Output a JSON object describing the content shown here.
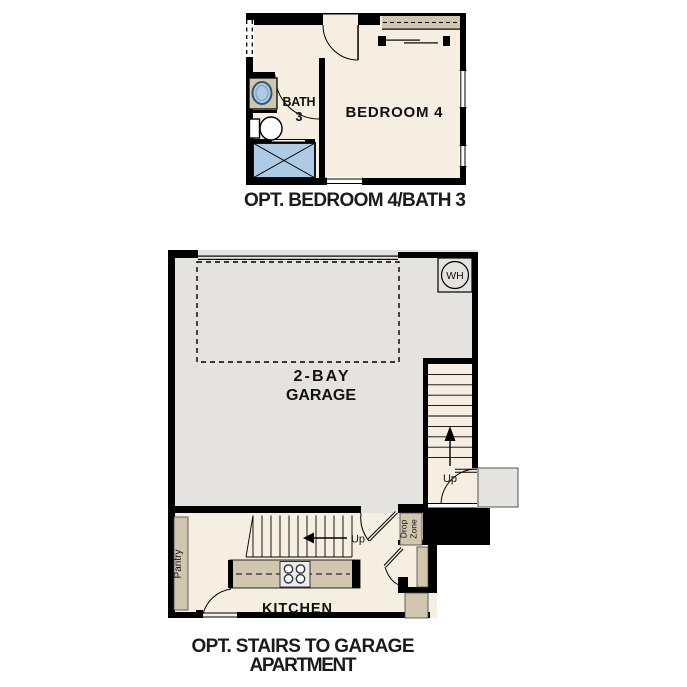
{
  "plan_bedroom": {
    "caption": "OPT. BEDROOM 4/BATH 3",
    "labels": {
      "bath_line1": "BATH",
      "bath_line2": "3",
      "bedroom": "BEDROOM 4"
    }
  },
  "plan_garage": {
    "caption_line1": "OPT. STAIRS TO GARAGE",
    "caption_line2": "APARTMENT",
    "labels": {
      "garage_line1": "2-BAY",
      "garage_line2": "GARAGE",
      "water_heater": "WH",
      "up_right_stairs": "Up",
      "up_kitchen_stairs": "Up",
      "pantry": "Pantry",
      "drop_zone_line1": "Drop",
      "drop_zone_line2": "Zone",
      "kitchen": "KITCHEN"
    }
  },
  "colors": {
    "room_fill": "#f6efe1",
    "cabinet_tan": "#d2c7ae",
    "garage_gray": "#e4e3e0",
    "fixture_blue": "#aecbe6",
    "wall_black": "#000000"
  }
}
